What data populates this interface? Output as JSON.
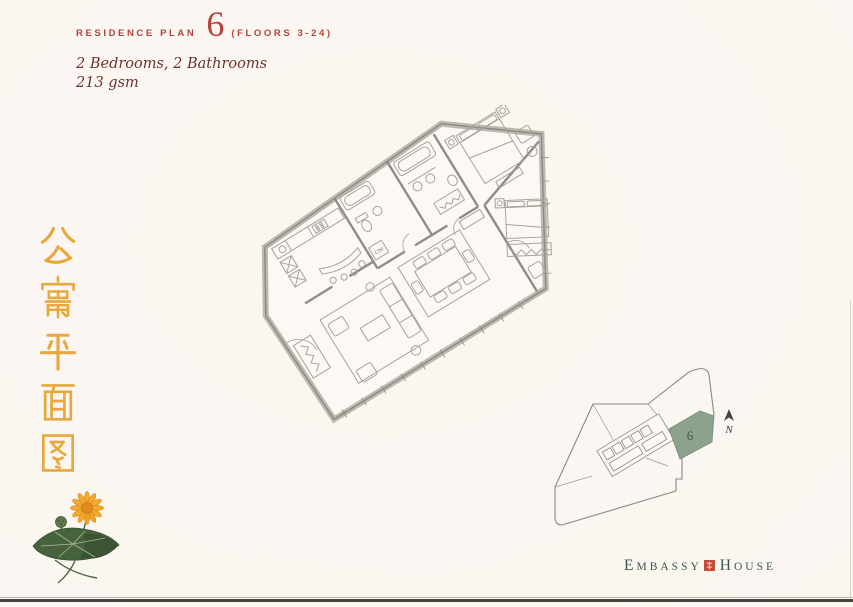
{
  "header": {
    "series_label": "RESIDENCE PLAN",
    "plan_number": "6",
    "floors_label": "(FLOORS 3-24)"
  },
  "summary": {
    "line1": "2 Bedrooms, 2 Bathrooms",
    "line2": "213 gsm"
  },
  "side_title": {
    "text": "公寓平面图"
  },
  "floor_plan": {
    "closet_label": "C/M"
  },
  "key_plan": {
    "unit_label": "6",
    "compass_label": "N",
    "highlight_color": "#8ca28d"
  },
  "brand": {
    "word1": "EMBASSY",
    "word2": "HOUSE",
    "seal_color": "#c14b36"
  },
  "colors": {
    "accent_red": "#b0443c",
    "subtitle_maroon": "#6a332e",
    "gold": "#e7a83e",
    "brand_green": "#3c564c",
    "plan_line_gray": "#96948f"
  }
}
